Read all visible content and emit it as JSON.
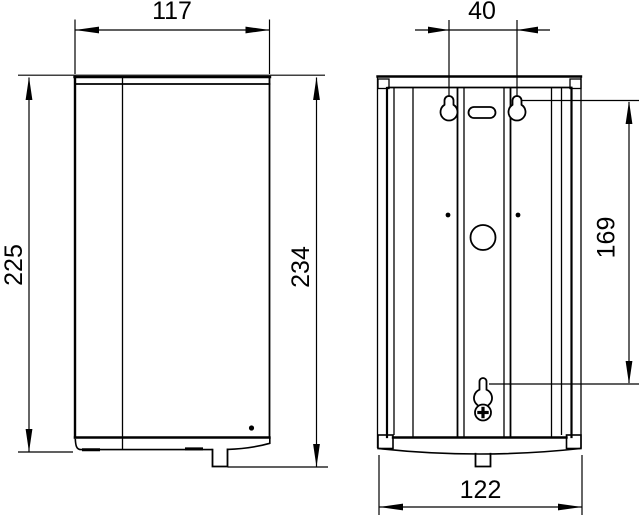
{
  "colors": {
    "line": "#000000",
    "background": "#ffffff"
  },
  "dimensions": {
    "front_width": "117",
    "front_body_height": "225",
    "front_total_height": "234",
    "rear_hole_spacing": "40",
    "rear_hole_vertical_distance": "169",
    "rear_width": "122"
  }
}
